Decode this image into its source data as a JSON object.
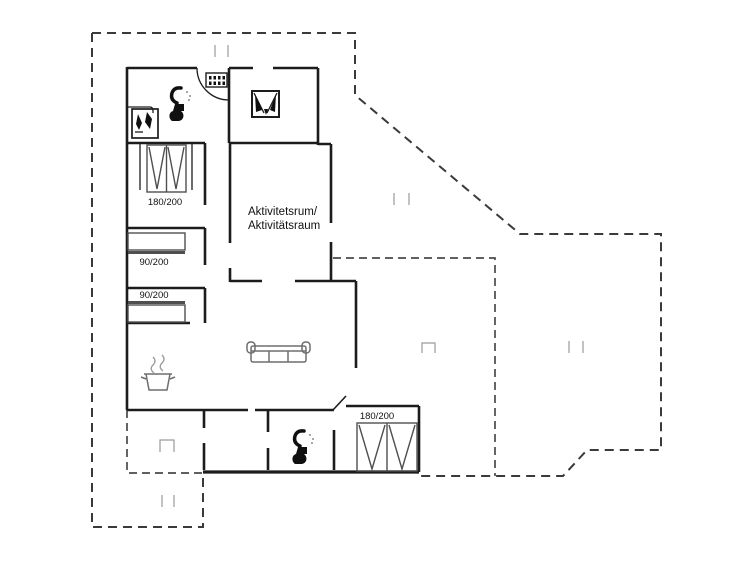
{
  "plan": {
    "title": "floor-plan",
    "room_label_line1": "Aktivitetsrum/",
    "room_label_line2": "Aktivitätsraum",
    "beds": {
      "double_top": "180/200",
      "single_upper": "90/200",
      "single_lower": "90/200",
      "double_bottom": "180/200"
    },
    "icons": {
      "entrance_door": "door-swing-arc",
      "dishwasher": "dishwasher-icon",
      "washing_machine": "washing-machine-icon",
      "shower": "shower-icon",
      "toilet": "toilet-icon",
      "wood_stove": "wood-burning-stove-icon",
      "cooking_pot": "cooking-pot-steam-icon",
      "sofa": "sofa-icon",
      "terrace_steps": "steps-tick-marks",
      "chimney": "open-square-marker"
    },
    "colors": {
      "wall": "#1c1c1c",
      "boundary": "#3a3a3a",
      "inner_boundary": "#4a4a4a",
      "tick": "#b3b3b3",
      "furniture": "#4f4f4f",
      "furniture_soft": "#6e6e6e",
      "steam": "#9a9a9a",
      "marker": "#9a9a9a",
      "icon_fill": "#101010",
      "text": "#111111",
      "background": "#ffffff"
    }
  }
}
